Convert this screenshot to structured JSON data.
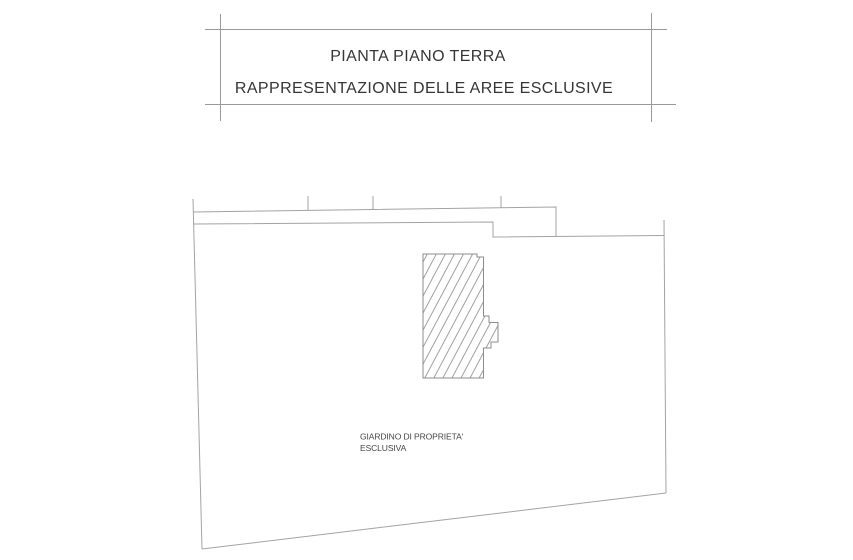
{
  "title_block": {
    "line1": "PIANTA PIANO TERRA",
    "line2": "RAPPRESENTAZIONE DELLE AREE ESCLUSIVE"
  },
  "plan": {
    "garden_label_line1": "GIARDINO DI PROPRIETA'",
    "garden_label_line2": "ESCLUSIVA"
  },
  "colors": {
    "line": "#a3a3a3",
    "outline": "#8c8c8c",
    "frame": "#999999",
    "hatch": "#a0a0a0",
    "text": "#353535",
    "label": "#454545",
    "background": "#ffffff"
  }
}
